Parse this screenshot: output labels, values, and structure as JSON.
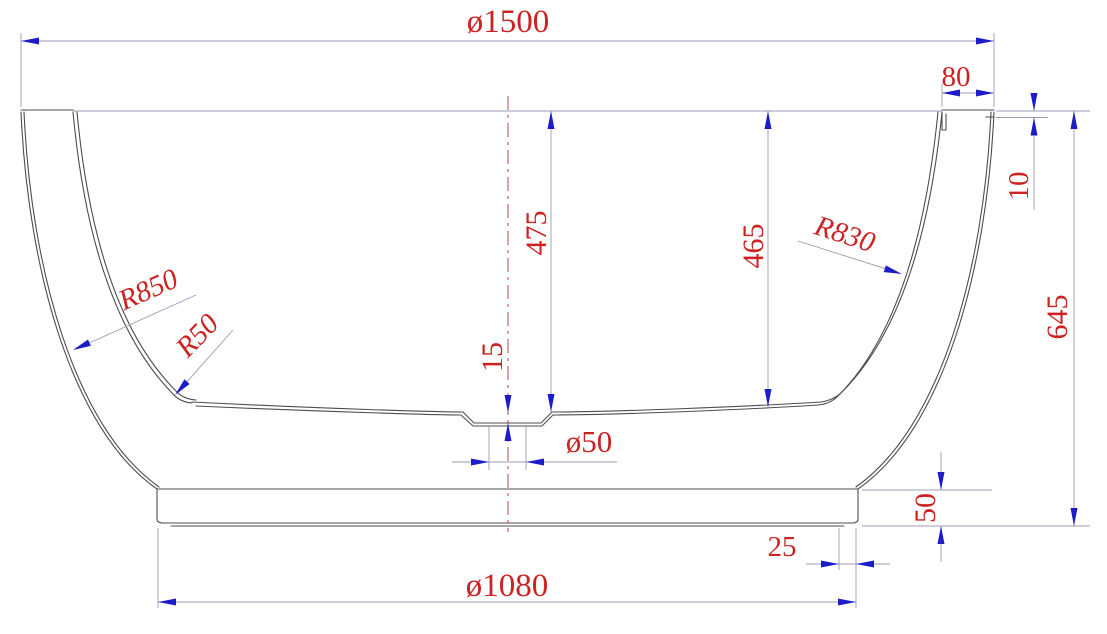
{
  "drawing": {
    "type": "technical-drawing",
    "subject": "bathtub cross-section with dimensions",
    "units": "mm",
    "colors": {
      "dimension_text": "#cc2222",
      "arrowhead": "#1c1cc8",
      "dimension_line": "#9b9bb8",
      "geometry_line": "#4d4d4d",
      "centerline": "#b04848",
      "background": "#ffffff"
    },
    "dimensions": {
      "overall_diameter": "ø1500",
      "rim_width": "80",
      "rim_step_height": "10",
      "overall_height": "645",
      "inner_depth_center": "475",
      "inner_depth_side": "465",
      "inner_wall_radius": "R830",
      "outer_wall_radius": "R850",
      "floor_corner_radius": "R50",
      "drain_recess_depth": "15",
      "drain_diameter": "ø50",
      "base_height": "50",
      "base_edge_inset": "25",
      "base_diameter": "ø1080"
    }
  }
}
